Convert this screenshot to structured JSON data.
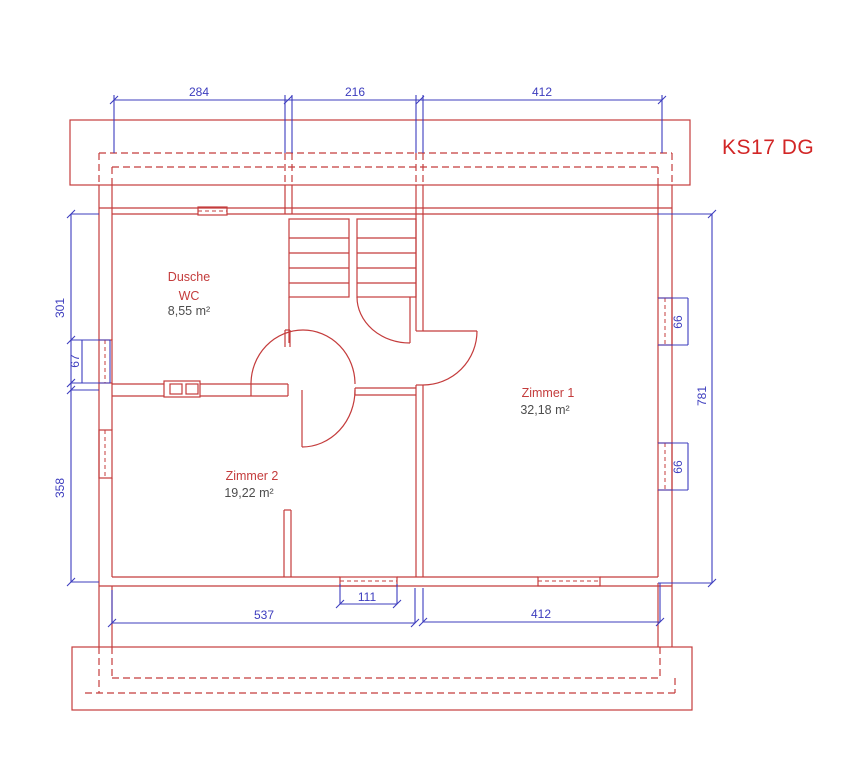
{
  "title": "KS17 DG",
  "colors": {
    "red": "#c43c3c",
    "blue": "#3c3cbe",
    "title": "#d22626",
    "gray": "#4d4d4d"
  },
  "rooms": {
    "dusche": {
      "name": "Dusche",
      "name2": "WC",
      "area": "8,55 m²"
    },
    "zimmer1": {
      "name": "Zimmer 1",
      "area": "32,18 m²"
    },
    "zimmer2": {
      "name": "Zimmer 2",
      "area": "19,22 m²"
    }
  },
  "dimensions": {
    "top": [
      "284",
      "216",
      "412"
    ],
    "left": [
      "301",
      "67",
      "358"
    ],
    "right_windows": [
      "66",
      "66"
    ],
    "right_total": "781",
    "bottom": [
      "537",
      "111",
      "412"
    ]
  }
}
